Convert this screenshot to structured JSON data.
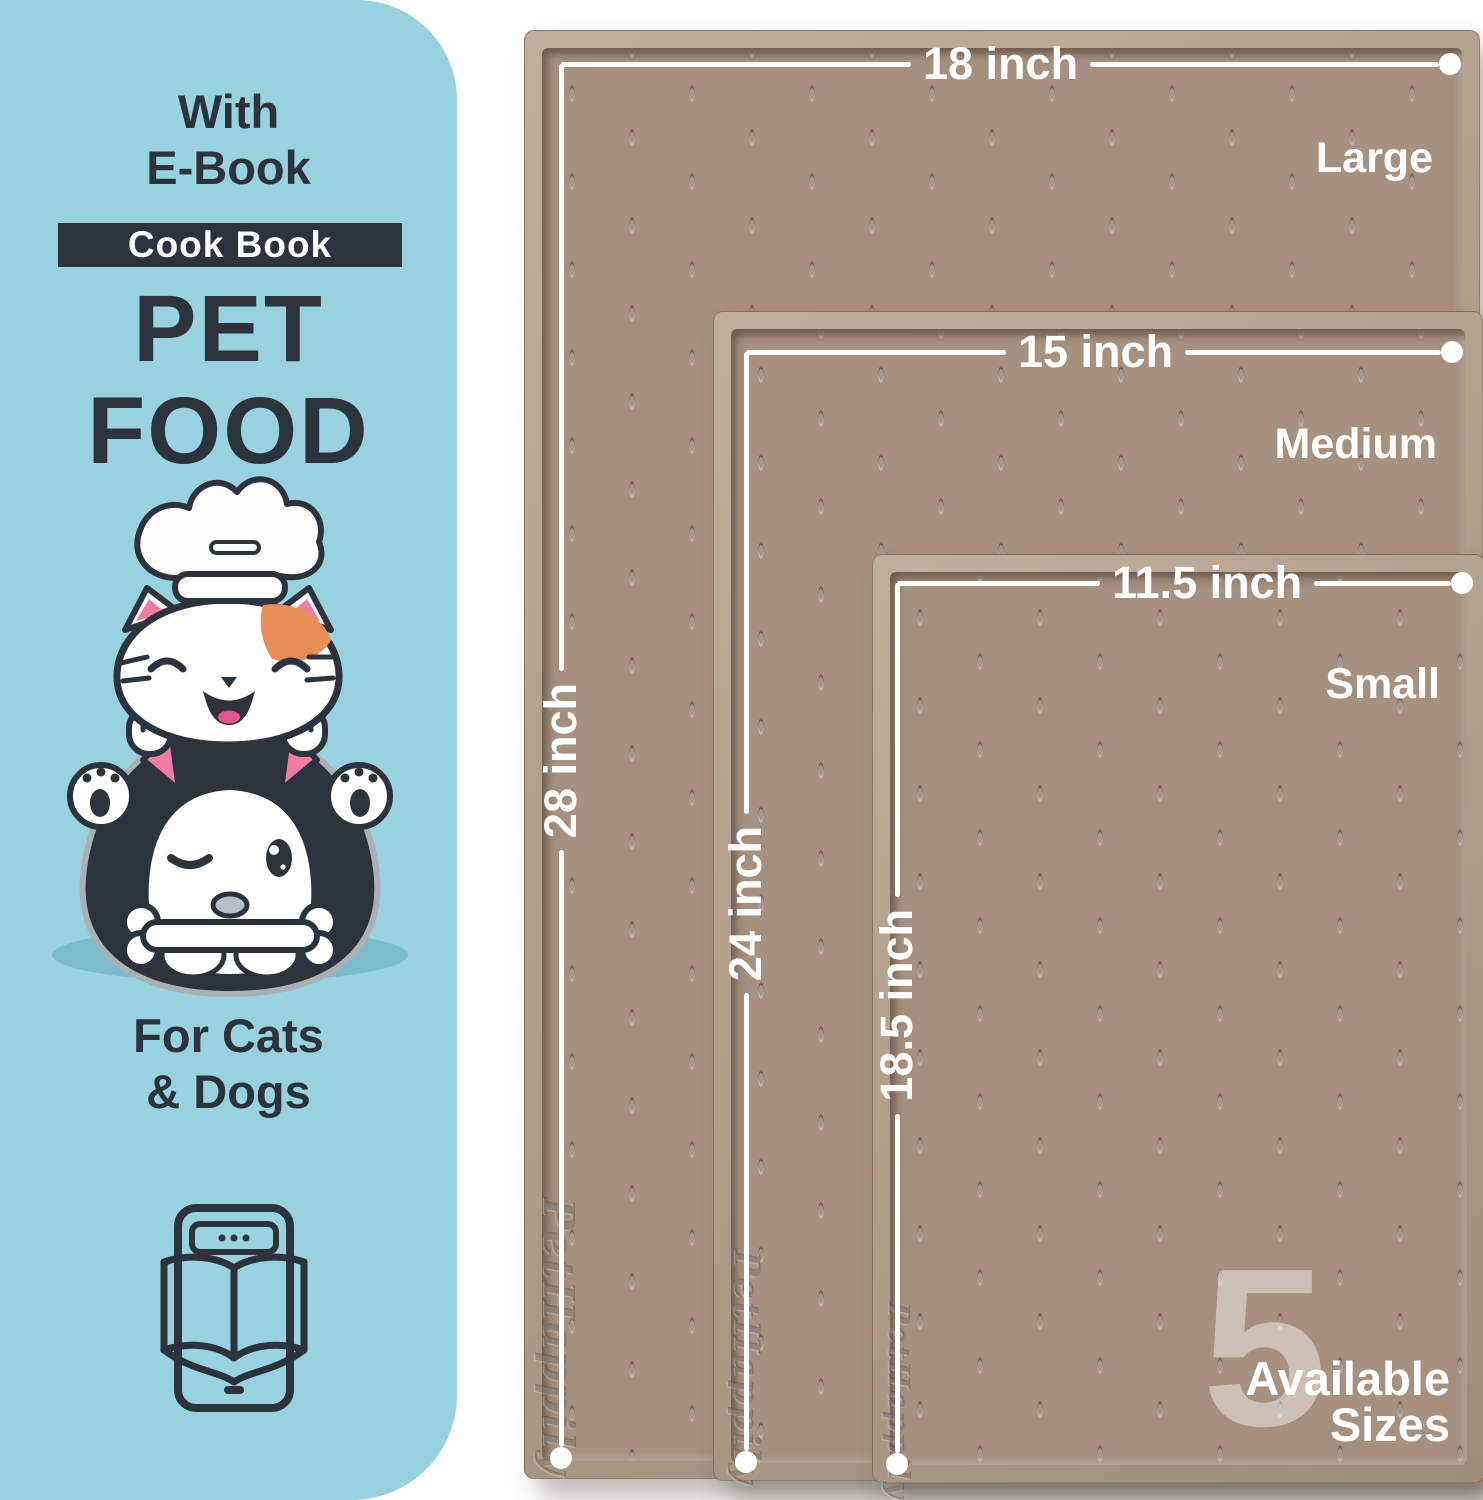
{
  "panel": {
    "pre_title_line1": "With",
    "pre_title_line2": "E-Book",
    "badge_label": "Cook Book",
    "title_line1": "PET",
    "title_line2": "FOOD",
    "subtitle_line1": "For Cats",
    "subtitle_line2": "& Dogs"
  },
  "mats": [
    {
      "name": "Large",
      "width_label": "18 inch",
      "height_label": "28 inch"
    },
    {
      "name": "Medium",
      "width_label": "15 inch",
      "height_label": "24 inch"
    },
    {
      "name": "Small",
      "width_label": "11.5 inch",
      "height_label": "18.5 inch"
    }
  ],
  "availability": {
    "count": "5",
    "line1": "Available",
    "line2": "Sizes"
  },
  "brand_emboss": "PetHappily",
  "colors": {
    "panel_bg": "#97d2de",
    "ink": "#2c333c",
    "mat_surface": "#a69181",
    "mat_rim": "#b5a493",
    "dimension_line": "#ffffff",
    "accent_orange": "#e78f57",
    "accent_pink": "#f07ca3",
    "tongue_pink": "#e8548d",
    "shadow_blue": "#7cbdcb"
  }
}
